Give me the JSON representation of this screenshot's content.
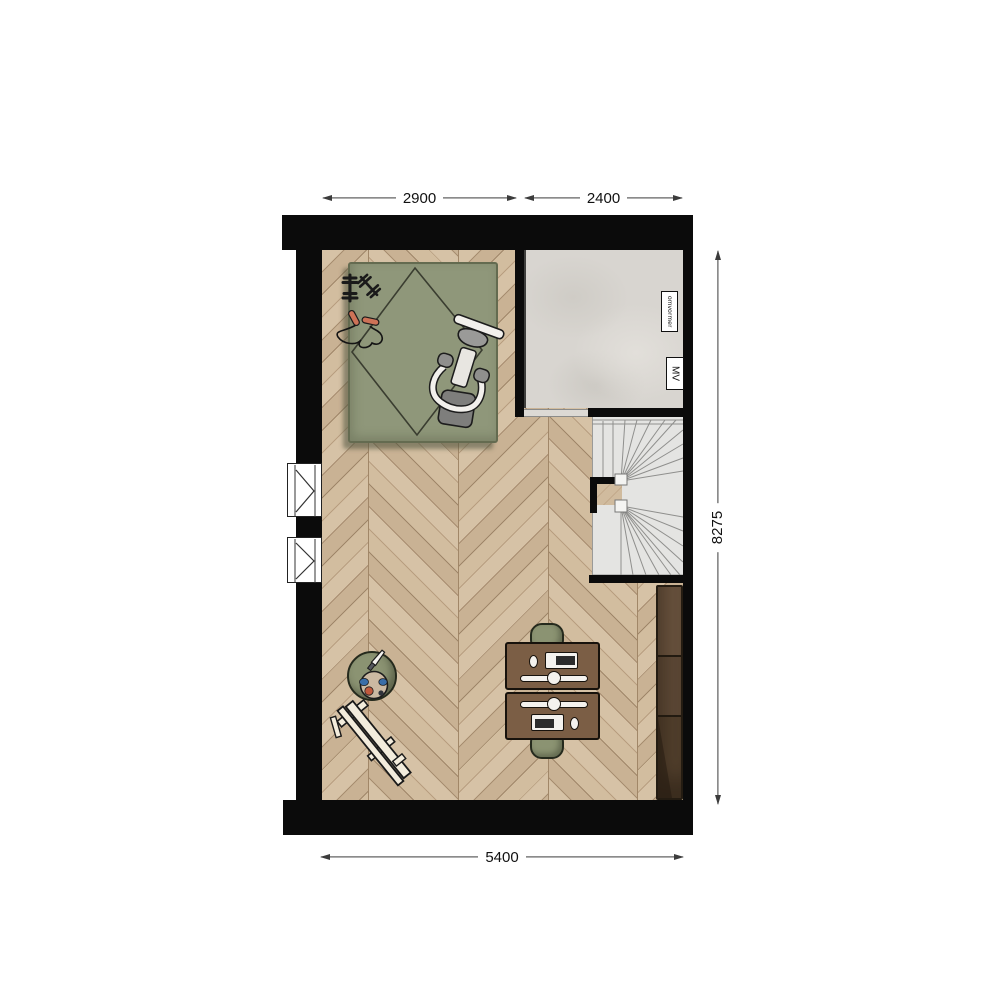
{
  "plan": {
    "dimensions": {
      "top_left": "2900",
      "top_right": "2400",
      "right_side": "8275",
      "bottom": "5400"
    },
    "labels": {
      "inverter": "omvormer",
      "ventilation": "MV"
    },
    "colors": {
      "wall": "#0b0b0b",
      "wood_light": "#d6c2a6",
      "wood_dark": "#b89e80",
      "concrete": "#d8d5d0",
      "stair": "#e4e4e2",
      "rug": "#8f977a",
      "desk": "#7b5e45",
      "sideboard": "#5f4a37",
      "chair": "#8b9372",
      "rope_handle": "#cd7257",
      "dimension_line": "#3c3c3c"
    },
    "furniture": [
      "exercise-rug",
      "exercise-bike",
      "dumbbells",
      "jump-rope",
      "winder-staircase",
      "double-desk",
      "office-chairs",
      "sideboard",
      "stool-with-palette",
      "easel"
    ]
  }
}
